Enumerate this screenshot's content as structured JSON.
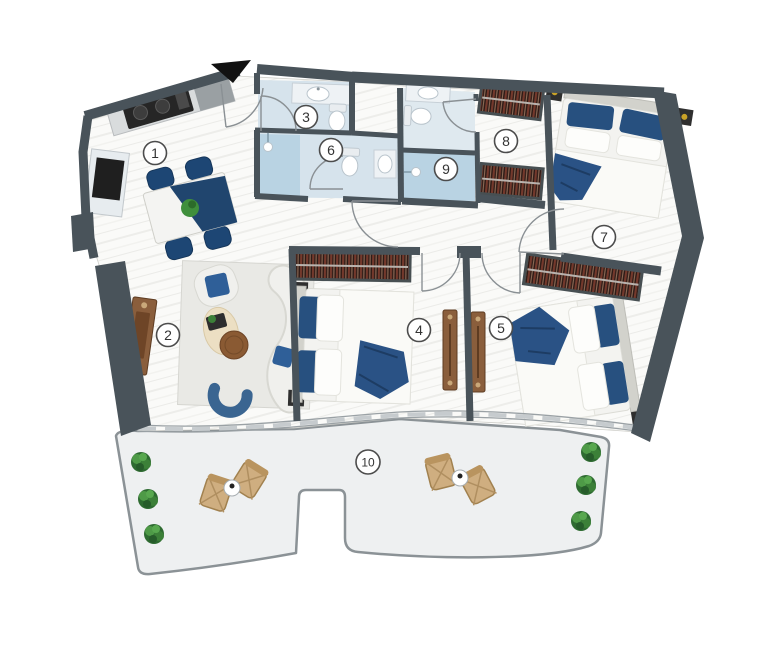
{
  "floor_plan": {
    "entrance_marker": "black-triangle-down",
    "rooms": [
      {
        "number": "1",
        "name": "kitchen-dining"
      },
      {
        "number": "2",
        "name": "living-room"
      },
      {
        "number": "3",
        "name": "bathroom"
      },
      {
        "number": "4",
        "name": "bedroom"
      },
      {
        "number": "5",
        "name": "bedroom"
      },
      {
        "number": "6",
        "name": "shower-bathroom"
      },
      {
        "number": "7",
        "name": "master-bedroom"
      },
      {
        "number": "8",
        "name": "walk-in-closet"
      },
      {
        "number": "9",
        "name": "shower-room"
      },
      {
        "number": "10",
        "name": "balcony-terrace"
      }
    ],
    "colors": {
      "wall": "#49535a",
      "floor": "#f9f9f7",
      "bathroom_tile": "#d6e3ec",
      "shower_tile": "#b9d3e3",
      "balcony_floor": "#eef0f1",
      "wardrobe_dark": "#2b1a16",
      "wardrobe_stripe": "#74392c",
      "bed_blue": "#2f5f98",
      "throw_navy": "#2a5285",
      "wood_brown": "#8a5e3c",
      "plant_green": "#3c8038",
      "wicker_tan": "#cfae80"
    }
  }
}
